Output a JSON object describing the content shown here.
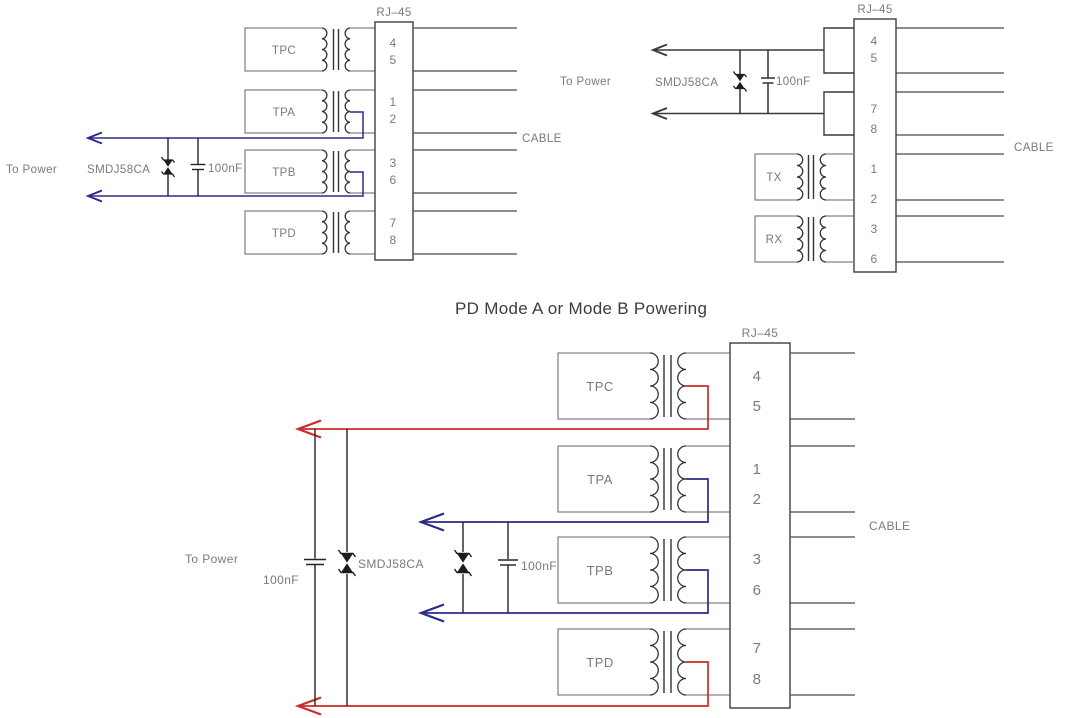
{
  "title": "PD Mode A or Mode B Powering",
  "shared": {
    "connector": "RJ–45",
    "cable": "CABLE",
    "to_power": "To Power",
    "tvs": "SMDJ58CA",
    "cap": "100nF"
  },
  "top_left": {
    "transformers": [
      "TPC",
      "TPA",
      "TPB",
      "TPD"
    ],
    "pins": [
      "4",
      "5",
      "1",
      "2",
      "3",
      "6",
      "7",
      "8"
    ]
  },
  "top_right": {
    "transformers": [
      "TX",
      "RX"
    ],
    "pins": [
      "4",
      "5",
      "7",
      "8",
      "1",
      "2",
      "3",
      "6"
    ]
  },
  "bottom": {
    "transformers": [
      "TPC",
      "TPA",
      "TPB",
      "TPD"
    ],
    "pins": [
      "4",
      "5",
      "1",
      "2",
      "3",
      "6",
      "7",
      "8"
    ],
    "cap_left": "100nF",
    "cap_right": "100nF"
  },
  "colors": {
    "wire_navy": "#2b2b8a",
    "wire_red": "#cd2b28",
    "line_dark": "#3f3f3f",
    "line_gray": "#858585",
    "text_gray": "#7a7a7a"
  }
}
